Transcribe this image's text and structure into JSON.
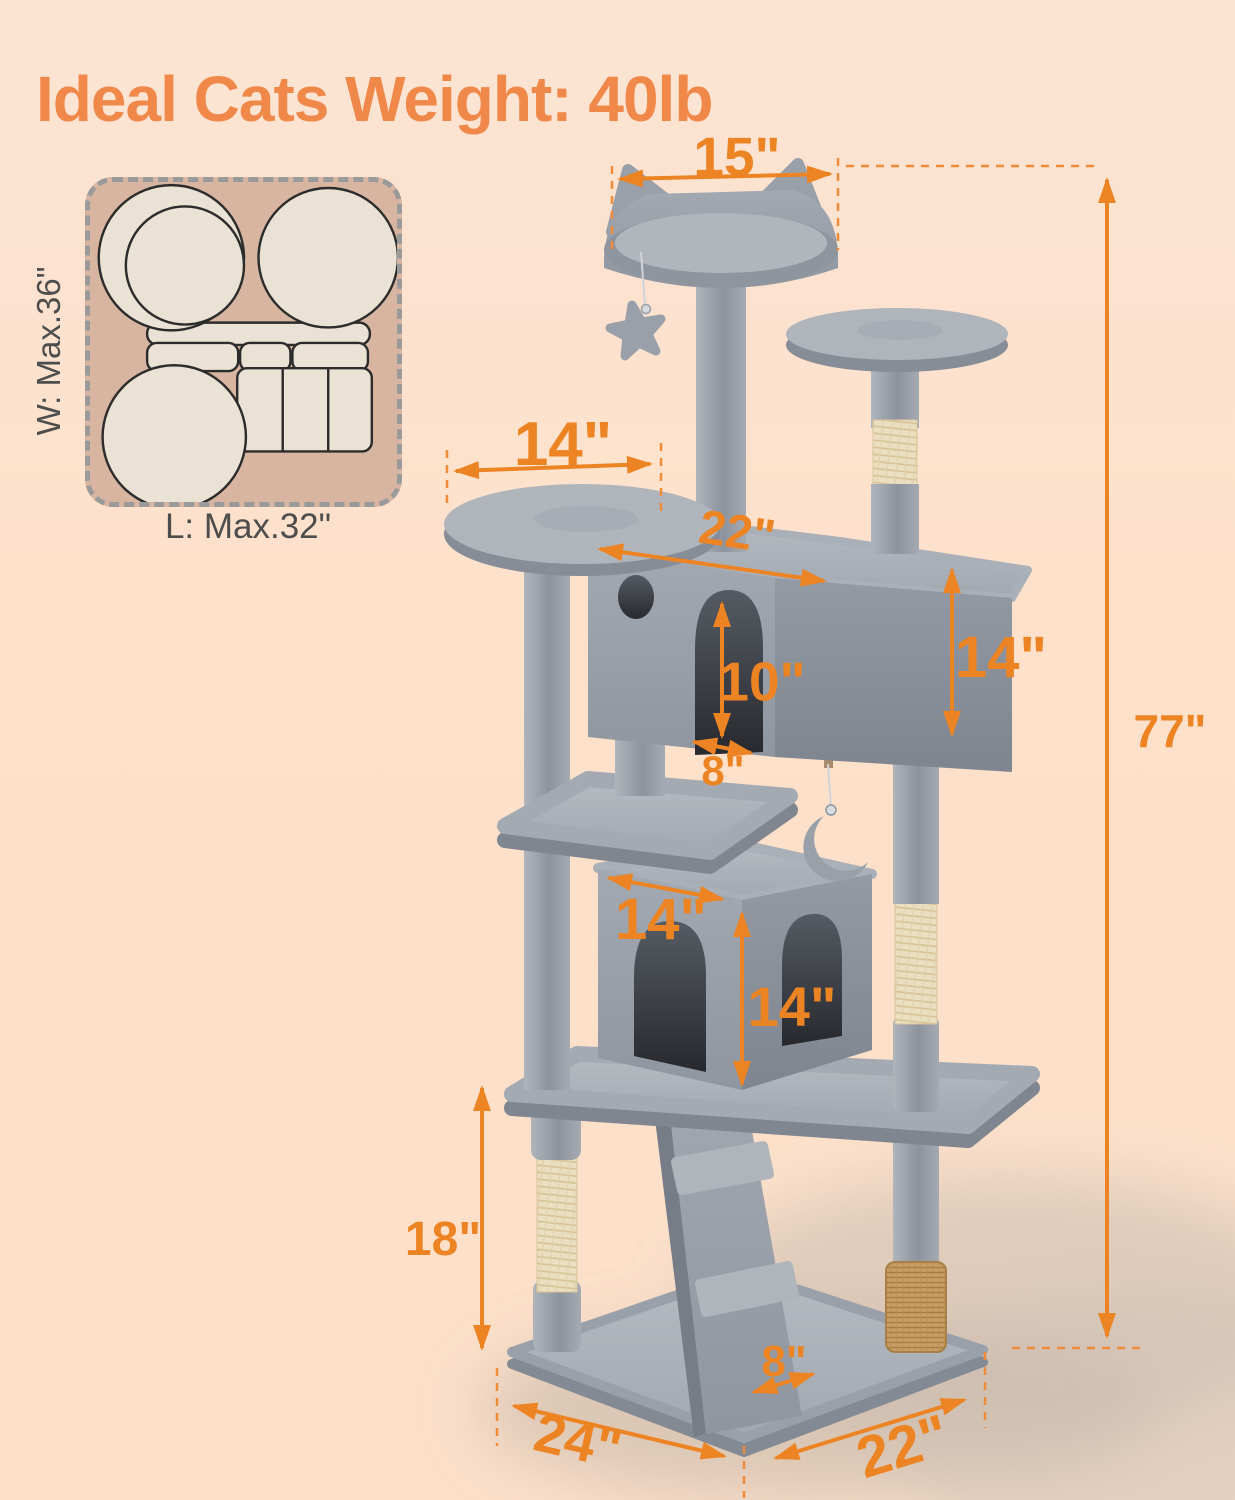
{
  "title": "Ideal Cats Weight: 40lb",
  "inset": {
    "width_label": "W: Max.36\"",
    "length_label": "L: Max.32\""
  },
  "dimensions": {
    "top_perch_width": "15\"",
    "left_platform_width": "14\"",
    "upper_condo_width": "22\"",
    "upper_condo_door_height": "10\"",
    "upper_condo_height": "14\"",
    "upper_condo_door_width": "8\"",
    "lower_condo_width": "14\"",
    "lower_condo_height": "14\"",
    "bottom_section_height": "18\"",
    "ramp_width": "8\"",
    "total_height": "77\"",
    "base_depth": "24\"",
    "base_width": "22\""
  },
  "colors": {
    "accent_orange": "#ED8424",
    "title_orange": "#F0884A",
    "tree_gray": "#9AA0A9",
    "sisal_tan": "#EADFC0",
    "inset_tan": "#D8B5A0",
    "background_peach": "#FBDFC9"
  }
}
